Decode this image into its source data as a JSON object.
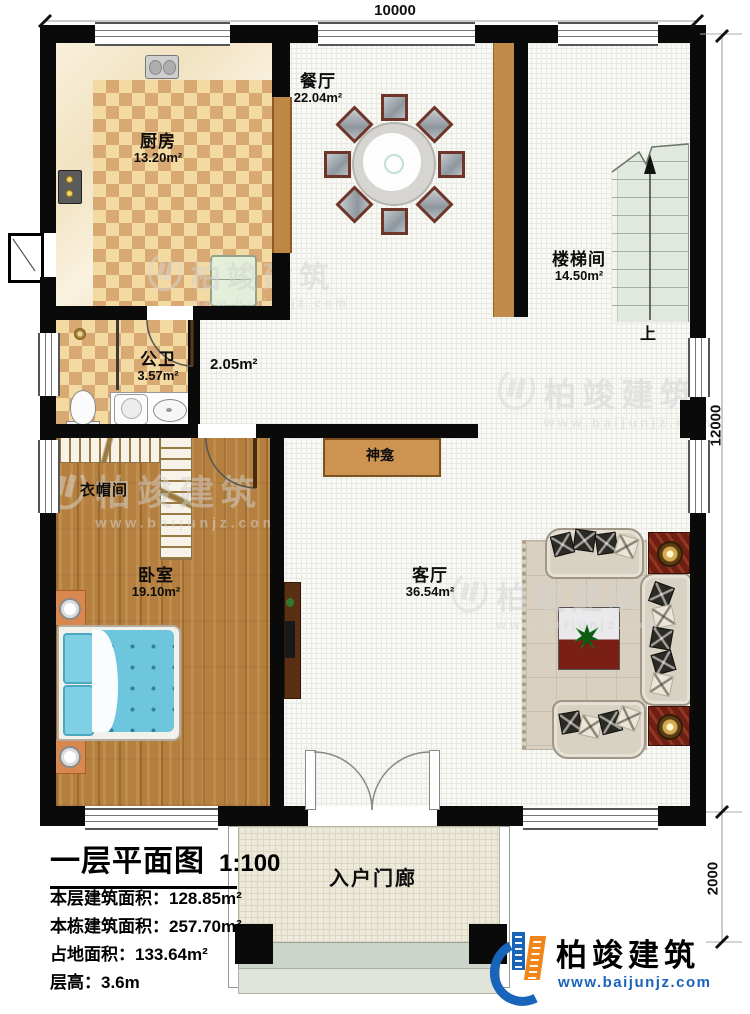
{
  "title_block": {
    "title": "一层平面图",
    "scale": "1:100",
    "stats": [
      {
        "text": "本层建筑面积：128.85m²"
      },
      {
        "text": "本栋建筑面积：257.70m²"
      },
      {
        "text": "占地面积：133.64m²"
      },
      {
        "text": "层高：3.6m"
      }
    ]
  },
  "dimensions": {
    "top": "10000",
    "right": "12000",
    "bottom_right": "2000"
  },
  "rooms": {
    "dining": {
      "name": "餐厅",
      "area": "22.04m²"
    },
    "kitchen": {
      "name": "厨房",
      "area": "13.20m²"
    },
    "stairwell": {
      "name": "楼梯间",
      "area": "14.50m²",
      "direction": "上"
    },
    "bathroom": {
      "name": "公卫",
      "area": "3.57m²"
    },
    "hallway": {
      "area": "2.05m²"
    },
    "cloakroom": {
      "name": "衣帽间"
    },
    "bedroom": {
      "name": "卧室",
      "area": "19.10m²"
    },
    "living": {
      "name": "客厅",
      "area": "36.54m²"
    },
    "shrine": {
      "name": "神龛"
    },
    "porch": {
      "name": "入户门廊"
    }
  },
  "branding": {
    "company": "柏竣建筑",
    "website": "www.baijunjz.com"
  },
  "watermark": {
    "company": "柏竣建筑",
    "website": "www.baijunjz.com"
  },
  "colors": {
    "wall": "#0a0a0a",
    "wood_door": "#bf8746",
    "accent_blue": "#1864ba",
    "accent_orange": "#f08519"
  }
}
